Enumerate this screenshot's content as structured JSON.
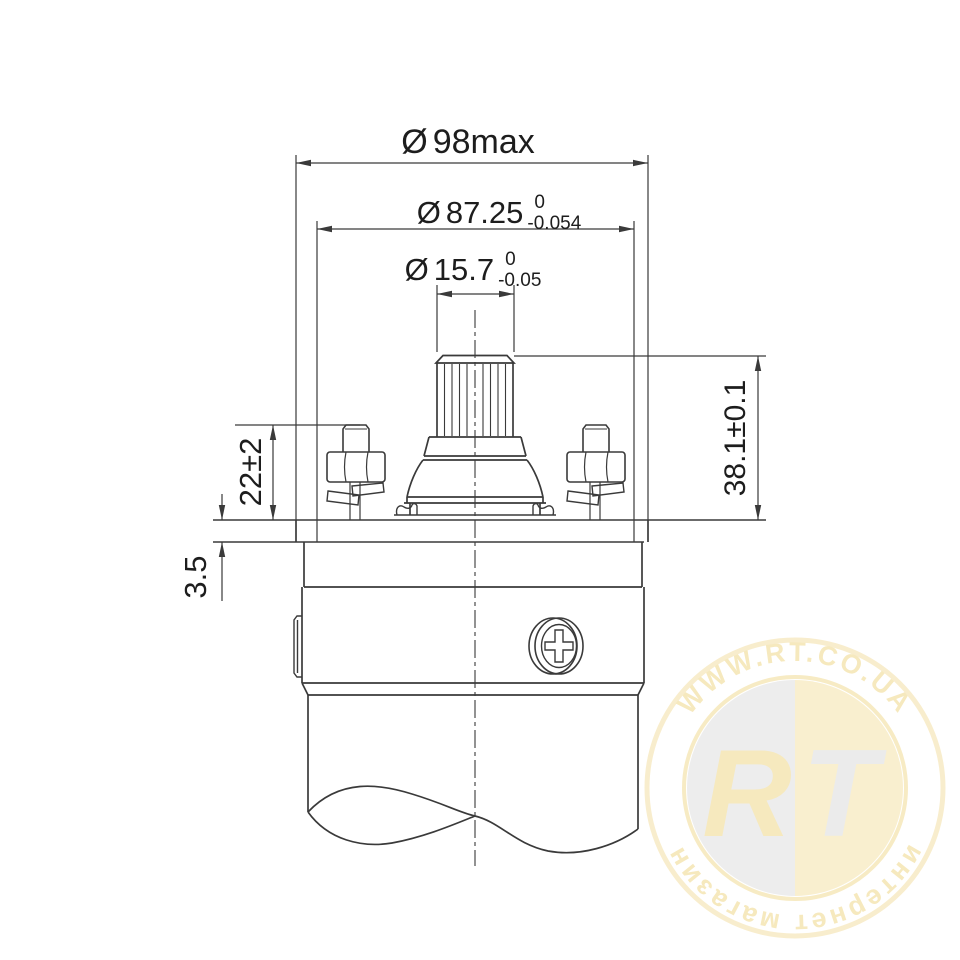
{
  "drawing": {
    "dia_max": {
      "symbol": "Ø",
      "value": "98max"
    },
    "dia_body": {
      "symbol": "Ø",
      "value": "87.25",
      "tol_upper": "0",
      "tol_lower": "-0.054"
    },
    "dia_shaft": {
      "symbol": "Ø",
      "value": "15.7",
      "tol_upper": "0",
      "tol_lower": "-0.05"
    },
    "height_shaft": "38.1±0.1",
    "height_terminal": "22±2",
    "flange_thickness": "3.5"
  },
  "watermark": {
    "site": "WWW.RT.CO.UA",
    "tagline": "интернет магазин",
    "monogram_left": "R",
    "monogram_right": "T",
    "colors": {
      "gold": "#eed584",
      "gold_light": "#f3dea0",
      "silver": "#d9d9d9"
    }
  }
}
